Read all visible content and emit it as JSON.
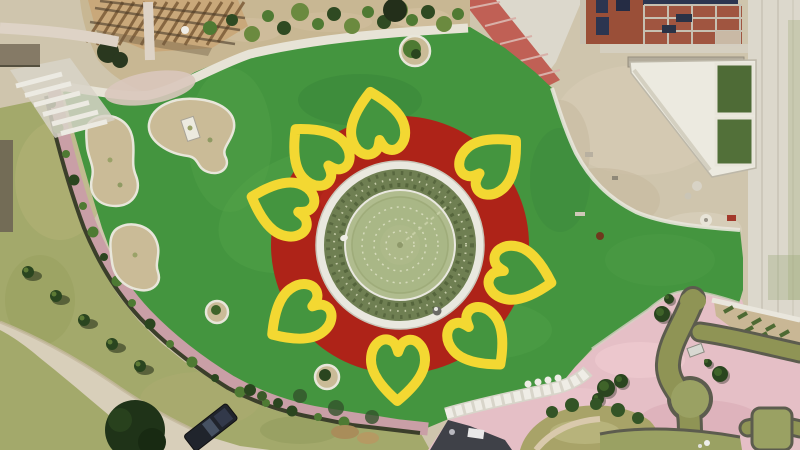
{
  "scene": {
    "title": "Aerial drone view of park with flower-shaped fountain plaza",
    "landmarks": [
      {
        "name": "central-fountain-pool",
        "desc": "circular pool with concentric fountain-jet rings, hedge ring and white walkway"
      },
      {
        "name": "flower-motif",
        "desc": "red circular apron with eight yellow heart-shaped petal outlines on green turf"
      },
      {
        "name": "timber-pergola",
        "desc": "slatted wooden pergola, top left"
      },
      {
        "name": "construction-building",
        "desc": "brick and concrete building frame under construction, top right"
      },
      {
        "name": "water-tanks",
        "desc": "two green-water tanks in white triangular enclosure"
      },
      {
        "name": "maze-garden",
        "desc": "winding olive ponds and lawns in pink paving, bottom right"
      },
      {
        "name": "service-road",
        "desc": "dirt road with parked dark SUV and tree rows, bottom left"
      }
    ],
    "colors": {
      "turf": "#44953f",
      "turf_light": "#55a44b",
      "turf_dark": "#37813a",
      "flower_red": "#ae2318",
      "petal_yellow": "#f3d832",
      "pond": "#b0bc8e",
      "pond_inner": "#a9b685",
      "ring_white": "#e9e8df",
      "veg": "#6f7f52",
      "veg_dark": "#45532f",
      "veg_light": "#ccd2b0",
      "path_pink": "#c99fa6",
      "plaza_pink": "#e5bfc6",
      "plaza_pink_light": "#f0cdd2",
      "plaza_pink_dark": "#d8a8b2",
      "sand": "#cfc5ad",
      "sand_light": "#ddd4bf",
      "concrete": "#dcd8cc",
      "concrete_bright": "#eceae2",
      "olive": "#a3a96b",
      "olive_light": "#bdb983",
      "road": "#d8cfba",
      "mulch": "#c8b793",
      "bed_fill": "#cabb97",
      "bed_rim": "#e8e6da",
      "hedge_dark": "#3b3f2a",
      "tuft_green": "#4e7a33",
      "tree_dark": "#2a451f",
      "tree_deep": "#1f3318",
      "canal": "#8f9455",
      "canal_edge": "#5c5c4e",
      "mound": "#9aa163",
      "wood": "#c9a87a",
      "wood_slat": "#7c5c38",
      "wood_beam": "#4a3a28",
      "brick_roof": "#a05540",
      "brick_wall": "#9a4f38",
      "navy": "#2c3550",
      "grid_line": "#c6c0b2",
      "tank_green": "#4e6b36",
      "brick_path": "#c06055",
      "vehicle_body": "#20242c",
      "shadow_dark": "#3f4148",
      "white": "#efede6"
    },
    "flower": {
      "center_x": 400,
      "center_y": 245,
      "red_disc_radius": 129,
      "white_ring_radius": 84,
      "veg_ring_radius": 66,
      "veg_ring_width": 20,
      "pond_radius": 54,
      "petal_count": 8,
      "petal_angles": [
        349,
        48,
        104,
        140,
        181,
        235,
        288,
        318
      ],
      "petal_radial_offset": 122,
      "petal_stroke_width": 10,
      "heart_path": "M0,-34 C-13,-23 -27,-8 -27,7 C-27,22 -16,31 -7,26 C-2.5,24 -1,18 0,15 C1,18 2.5,24 7,26 C16,31 27,22 27,7 C27,-8 13,-23 0,-34 Z",
      "fountain_ring_radii": [
        14,
        26,
        38,
        48
      ]
    },
    "planting": {
      "hedge_tufts": [
        [
          52,
          104
        ],
        [
          58,
          128
        ],
        [
          66,
          154
        ],
        [
          74,
          180
        ],
        [
          83,
          206
        ],
        [
          93,
          232
        ],
        [
          104,
          257
        ],
        [
          117,
          281
        ],
        [
          132,
          303
        ],
        [
          150,
          324
        ],
        [
          170,
          344
        ],
        [
          192,
          362
        ],
        [
          215,
          378
        ],
        [
          240,
          392
        ],
        [
          266,
          403
        ],
        [
          292,
          411
        ],
        [
          318,
          417
        ],
        [
          344,
          422
        ]
      ],
      "olive_trees": [
        [
          28,
          272
        ],
        [
          56,
          296
        ],
        [
          84,
          320
        ],
        [
          112,
          344
        ],
        [
          140,
          366
        ]
      ],
      "berm_shrubs": [
        [
          210,
          28,
          7
        ],
        [
          232,
          20,
          6
        ],
        [
          252,
          34,
          8
        ],
        [
          268,
          16,
          6
        ],
        [
          284,
          28,
          7
        ],
        [
          300,
          12,
          9
        ],
        [
          318,
          24,
          6
        ],
        [
          334,
          14,
          7
        ],
        [
          352,
          26,
          8
        ],
        [
          368,
          12,
          6
        ],
        [
          384,
          22,
          7
        ],
        [
          398,
          10,
          10
        ],
        [
          412,
          20,
          6
        ],
        [
          428,
          12,
          7
        ],
        [
          444,
          24,
          8
        ],
        [
          458,
          14,
          6
        ]
      ],
      "slope_dashes": [
        [
          724,
          312
        ],
        [
          738,
          318
        ],
        [
          752,
          324
        ],
        [
          766,
          330
        ],
        [
          780,
          336
        ],
        [
          744,
          332
        ],
        [
          758,
          338
        ],
        [
          772,
          344
        ]
      ],
      "plaza_trees": [
        [
          662,
          314,
          8
        ],
        [
          669,
          299,
          5
        ],
        [
          720,
          374,
          8
        ],
        [
          708,
          363,
          4
        ],
        [
          606,
          388,
          9
        ],
        [
          621,
          381,
          7
        ],
        [
          598,
          399,
          6
        ]
      ],
      "mound_shrubs": [
        [
          552,
          412,
          6
        ],
        [
          572,
          405,
          7
        ],
        [
          596,
          404,
          6
        ],
        [
          618,
          410,
          7
        ],
        [
          638,
          418,
          6
        ]
      ],
      "steps_blobs": [
        [
          528,
          384
        ],
        [
          538,
          382
        ],
        [
          548,
          380
        ],
        [
          558,
          378
        ]
      ],
      "turf_edge_shadows": [
        [
          300,
          396,
          7
        ],
        [
          336,
          408,
          8
        ],
        [
          372,
          417,
          7
        ]
      ]
    }
  }
}
